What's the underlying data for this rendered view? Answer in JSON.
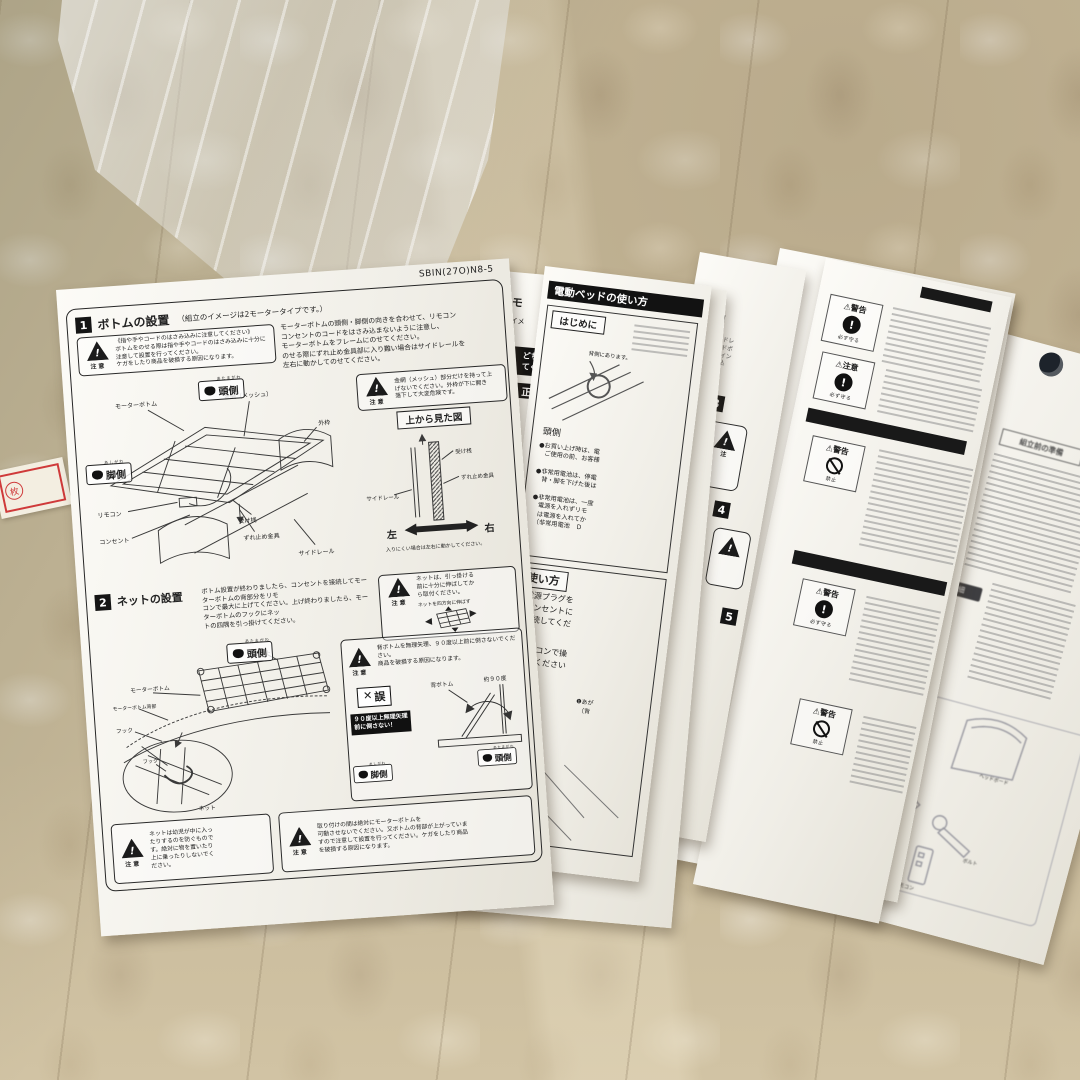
{
  "icons": {
    "warn": "⚠",
    "ex": "!",
    "cross": "✕"
  },
  "stamp": {
    "k": "枚"
  },
  "a": {
    "code": "SBIN(27O)N8-5",
    "chui": "注意",
    "s1num": "1",
    "s1title": "ボトムの設置",
    "s1note": "（組立のイメージは2モータータイプです。）",
    "s1caution": "《指や手やコードのはさみ込みに注意してください》\nボトムをのせる際は指や手やコードのはさみ込みに十分に注意して設置を行ってください。\nケガをしたり商品を破損する原因になります。",
    "s1body": "モーターボトムの頭側・脚側の向きを合わせて、リモコン\nコンセントのコードをはさみ込まないように注意し、\nモーターボトムをフレームにのせてください。\nのせる際にずれ止め金具部に入り難い場合はサイドレールを\n左右に動かしてのせてください。",
    "head": "頭側",
    "headRuby": "あたまがわ",
    "foot": "脚側",
    "footRuby": "あしがわ",
    "lb_motor": "モーターボトム",
    "lb_mesh": "金網（メッシュ）",
    "lb_frame": "外枠",
    "lb_remote": "リモコン",
    "lb_outlet": "コンセント",
    "lb_uke": "受け桟",
    "lb_zure": "ずれ止め金具",
    "lb_rail": "サイドレール",
    "meshCaution": "金網（メッシュ）部分だけを持って上\nげないでください。外枠が下に開き\n落下して大変危険です。",
    "topviewTitle": "上から見た図",
    "tvUke": "受け桟",
    "tvZure": "ずれ止め金具",
    "tvRail": "サイドレール",
    "tvLeft": "左",
    "tvRight": "右",
    "tvNote": "入りにくい場合は左右に動かしてください。",
    "s2num": "2",
    "s2title": "ネットの設置",
    "s2body": "ボトム設置が終わりましたら、コンセントを接続してモーターボトムの背部分をリモ\nコンで最大に上げてください。上げ終わりましたら、モーターボトムのフックにネッ\nトの四隅を引っ掛けてください。",
    "netCaution": "ネットは、引っ掛ける\n前に十分に伸ばしてか\nら取付ください。",
    "netStretch": "ネットを四方向に伸ばす",
    "lb_net": "ネット",
    "lb_motor2": "モーターボトム",
    "lb_back": "モーターボトム背部",
    "lb_hook": "フック",
    "lb_hook2": "フック",
    "lb_net2": "ネット",
    "tiltCaution": "背ボトムを無理矢理、９０度以上前に倒さないでください。\n商品を破損する原因になります。",
    "wrong": "誤",
    "tiltBan": "９０度以上無理矢理\n前に倒さない！",
    "lb_sebottom": "背ボトム",
    "lb_angle": "約９０度",
    "blCaution": "ネットは幼児が中に入っ\nたりするのを防ぐもので\nす。絶対に物を置いたり\n上に乗ったりしないでく\nださい。",
    "brCaution": "取り付けの間は絶対にモーターボトムを\n可動させないでください。又ボトムの背部が上がっていま\nすので注意して設置を行ってください。ケガをしたり商品\nを破損する原因になります。"
  },
  "b": {
    "t1": "（1モ",
    "t2": "立のイメ",
    "t3": "どちら\nてくだ",
    "t4": "正",
    "t5": "ください。",
    "code": "090810"
  },
  "c": {
    "header": "電動ベッドの使い方",
    "hajimeni": "はじめに",
    "se": "背側にあります。",
    "head": "頭側",
    "b1": "●お買い上げ時は、電\n　ご使用の前、お客様",
    "b2": "●非常用電池は、停電\n　背・脚を下げた後は",
    "b3": "●非常用電池は、一度\n　電源を入れずリモ\n　は電源を入れてか\n　（非常用電池　Ｄ",
    "usage": "使い方",
    "st1": "①電源プラグを\n　コンセントに\n　接続してくだ",
    "st2": "②リモコンで操\n　してください",
    "r1": "❶あが\n　（背",
    "r3": "❸あがる\n　（脚）",
    "r4": "る\n動）"
  },
  "d": {
    "n2": "2",
    "n3": "3",
    "n4": "4",
    "n5": "5",
    "lines": "サイドレ\nヘッドボ\nジョイン\n差し込",
    "chu": "注"
  },
  "e": {
    "warn": "警告",
    "chui": "注意",
    "mamoru": "必ず守る",
    "kinshi": "禁止"
  },
  "f": {
    "header": "組立前の準備",
    "badge": "部品明細",
    "p1": "ヘッドボード",
    "p2": "スパナ",
    "p3": "ボルト",
    "p4": "リモコン"
  }
}
